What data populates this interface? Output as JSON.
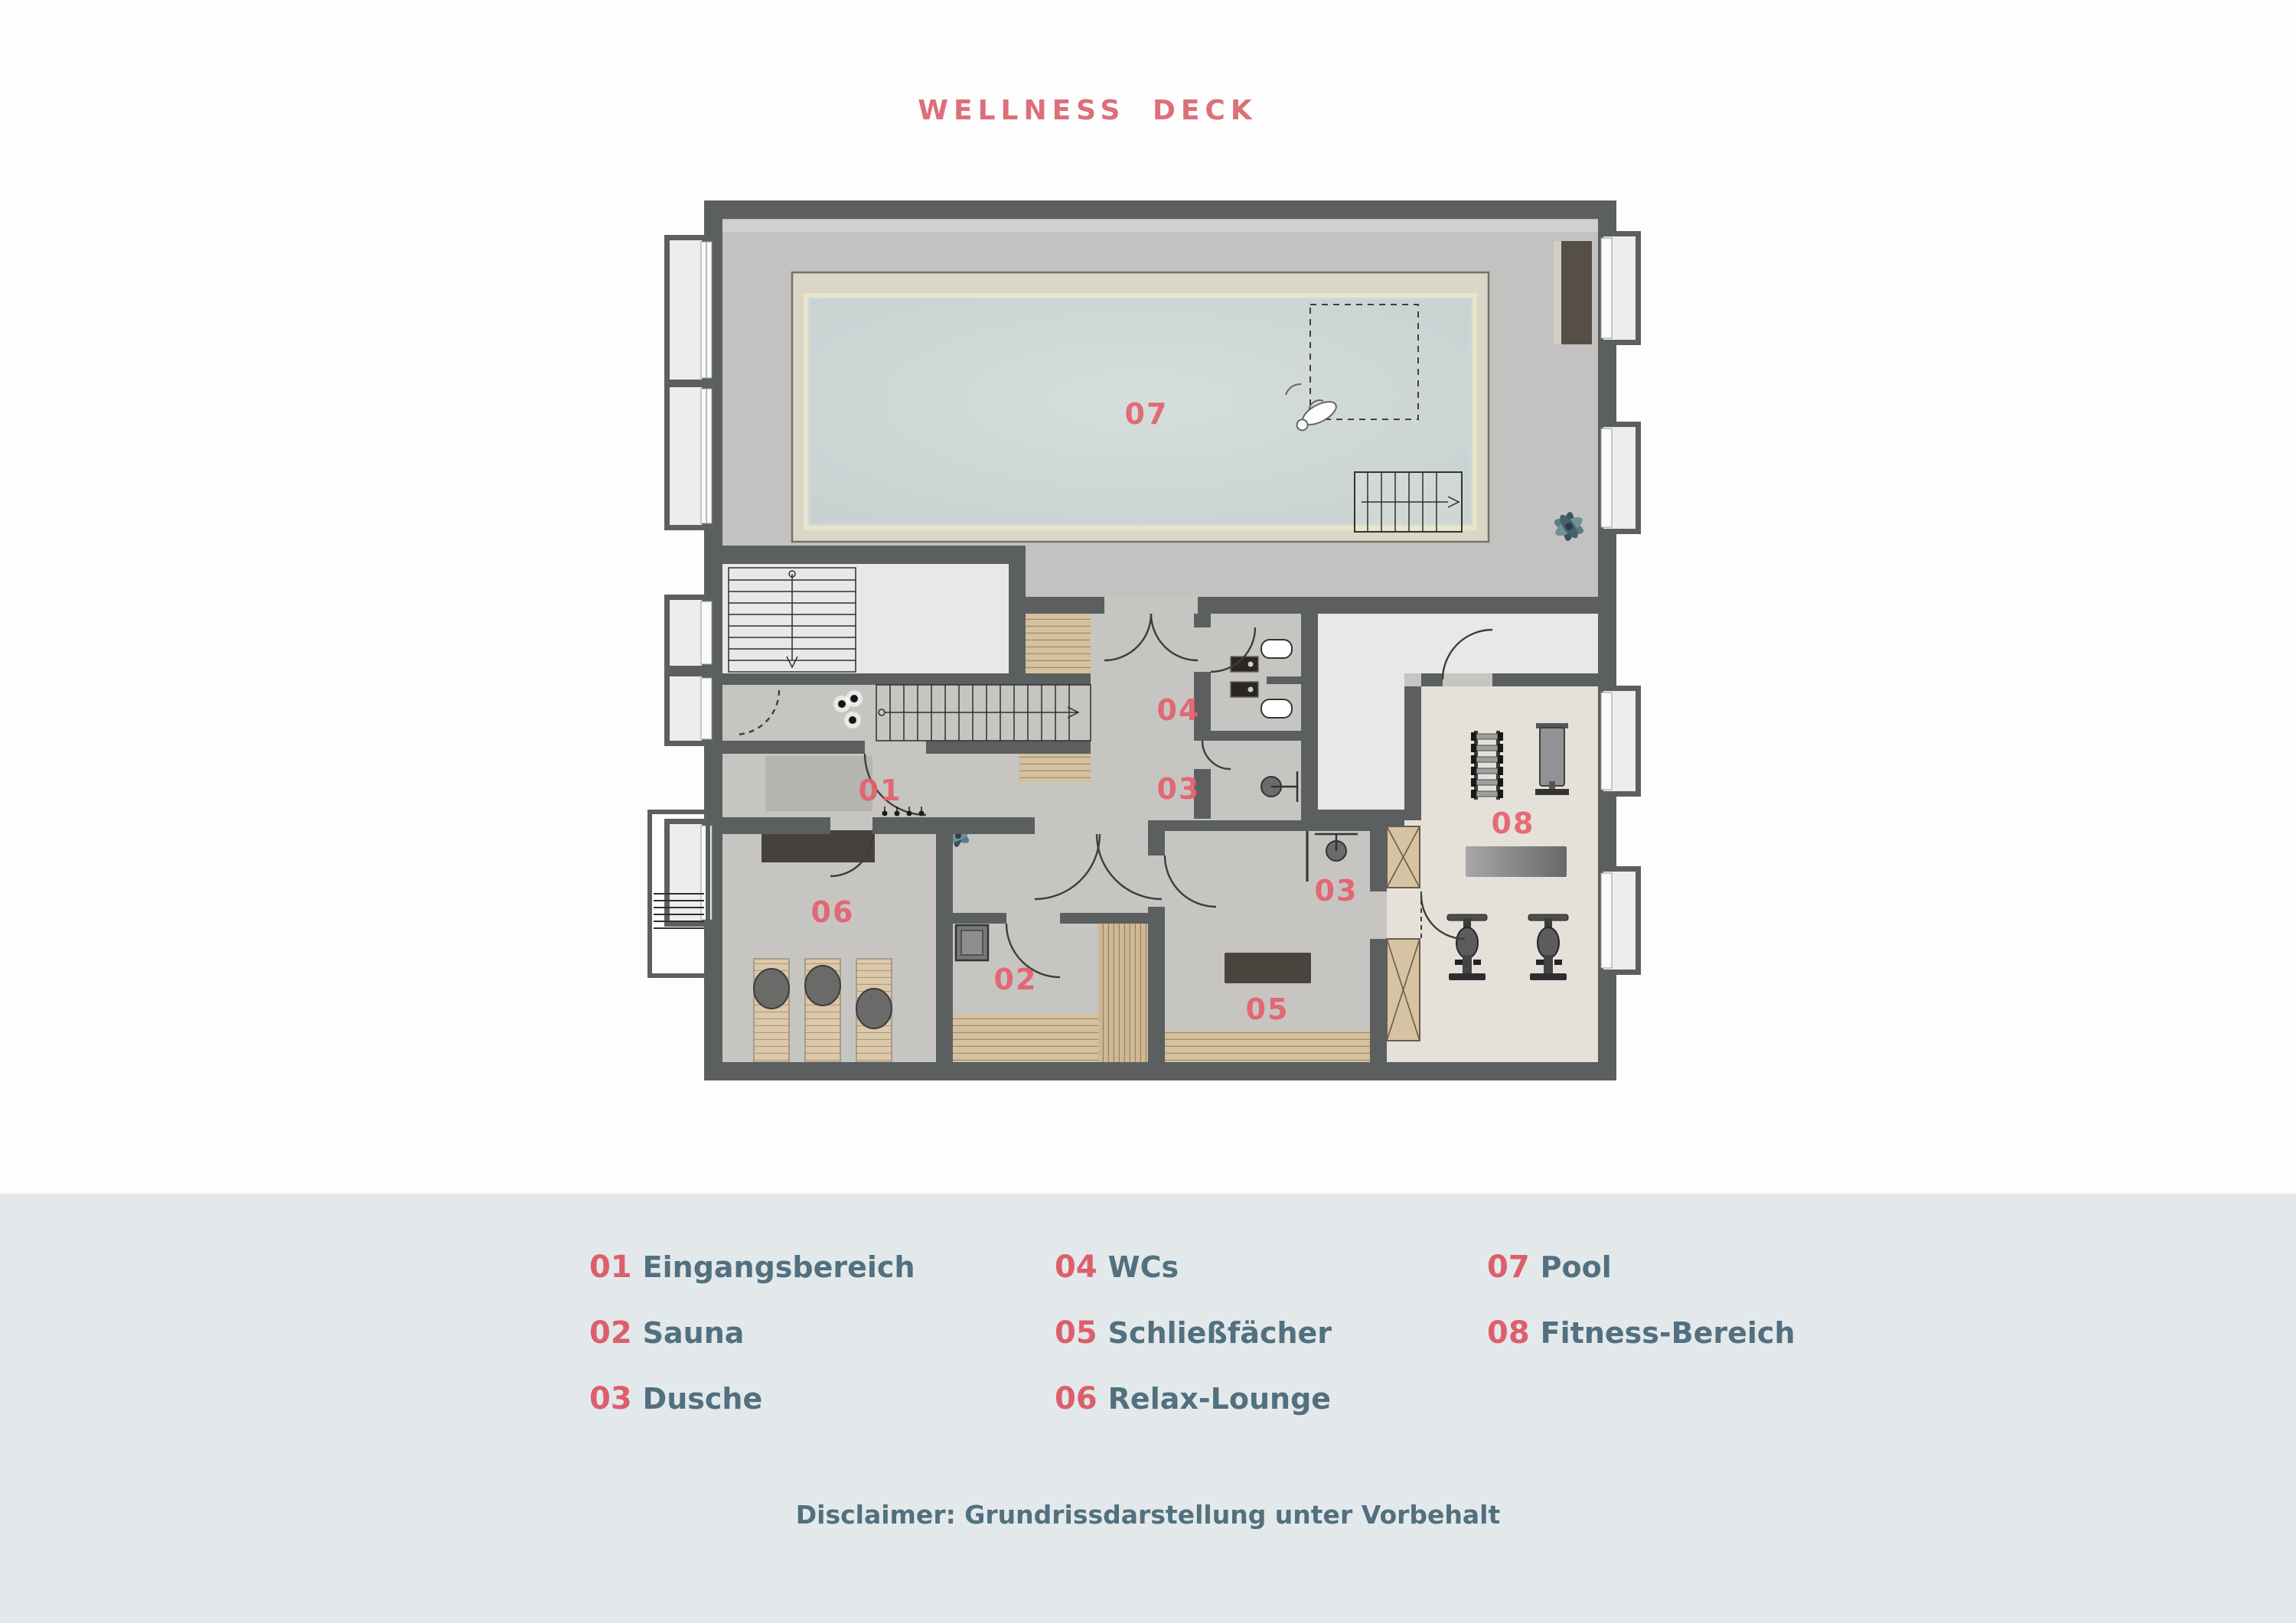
{
  "title": "WELLNESS DECK",
  "legend": {
    "items": [
      {
        "num": "01",
        "label": "Eingangsbereich"
      },
      {
        "num": "02",
        "label": "Sauna"
      },
      {
        "num": "03",
        "label": "Dusche"
      },
      {
        "num": "04",
        "label": "WCs"
      },
      {
        "num": "05",
        "label": "Schließfächer"
      },
      {
        "num": "06",
        "label": "Relax-Lounge"
      },
      {
        "num": "07",
        "label": "Pool"
      },
      {
        "num": "08",
        "label": "Fitness-Bereich"
      }
    ]
  },
  "disclaimer": "Disclaimer: Grundrissdarstellung unter Vorbehalt",
  "plan_markers": [
    {
      "text": "01"
    },
    {
      "text": "02"
    },
    {
      "text": "03"
    },
    {
      "text": "03"
    },
    {
      "text": "04"
    },
    {
      "text": "05"
    },
    {
      "text": "06"
    },
    {
      "text": "07"
    },
    {
      "text": "08"
    }
  ],
  "colors": {
    "accent_coral": "#dd5f6c",
    "label_slate": "#52707f",
    "legend_band": "#e3e9eb",
    "wall": "#5b5f60",
    "pool_water": "#cdd6d5",
    "pool_deck": "#dad6c8",
    "wood": "#d3bd9c",
    "fitness_floor": "#e5e1d9"
  }
}
